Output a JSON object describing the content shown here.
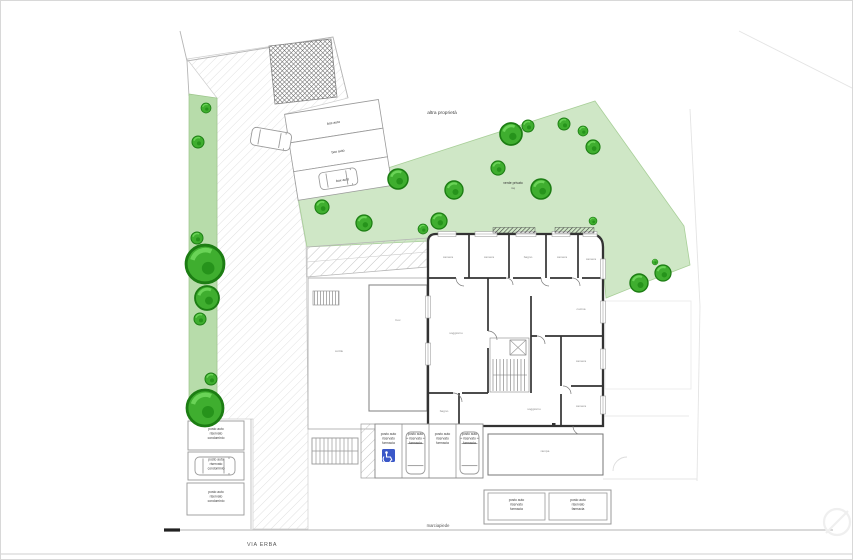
{
  "plan": {
    "labels": {
      "other_property": "altra proprietà",
      "private_green": "verde privato",
      "private_green_sub": "mq",
      "sidewalk": "marciapiede",
      "street": "VIA ERBA"
    },
    "box_auto": [
      "box auto",
      "box auto",
      "box auto"
    ],
    "condo_spot_lines": [
      "posto auto",
      "riservato",
      "condominio"
    ],
    "pharmacy_spot_lines": [
      "posto auto",
      "riservato",
      "farmacia"
    ],
    "rooms": [
      "camera",
      "camera",
      "bagno",
      "camera",
      "camera",
      "soggiorno",
      "cucina",
      "camera",
      "camera",
      "bagno",
      "soggiorno",
      "box",
      "cortile",
      "rampa"
    ],
    "icons": {
      "handicap": "wheelchair-icon"
    },
    "colors": {
      "garden": "#cfe7c6",
      "green_strip": "#b7dcaa",
      "tree": "#3fae2f",
      "wall": "#333333",
      "handicap_blue": "#3a57c8"
    }
  }
}
